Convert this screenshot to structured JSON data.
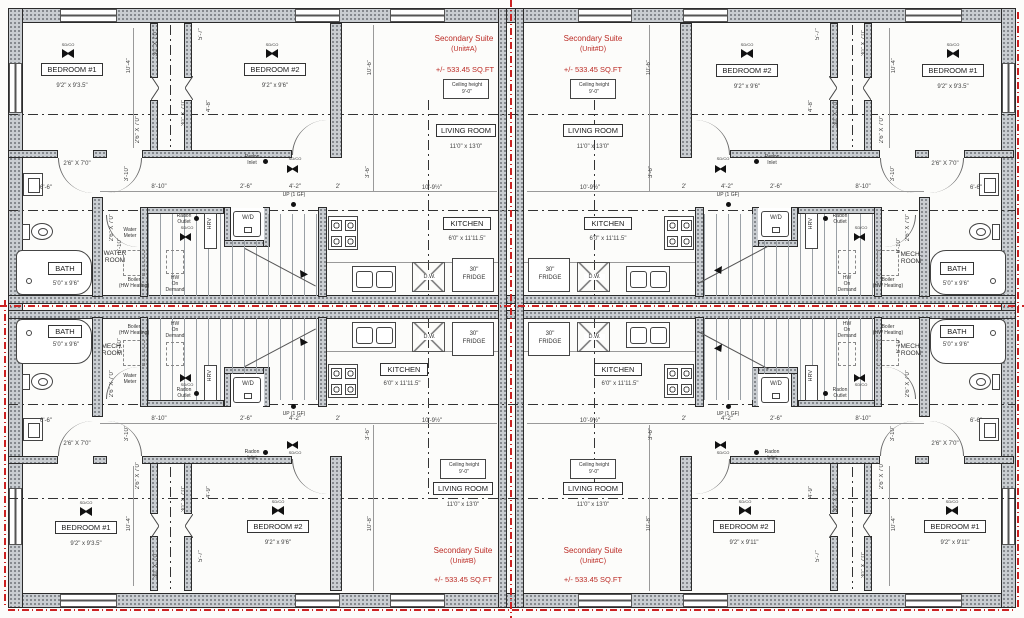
{
  "colors": {
    "accent_red": "#bb2b25",
    "wall_gray": "#c9cdd1"
  },
  "rooms": {
    "bedroom1": "BEDROOM #1",
    "bedroom2": "BEDROOM #2",
    "living": "LIVING ROOM",
    "kitchen": "KITCHEN",
    "bath": "BATH",
    "water_room": "WATER ROOM",
    "mech_room": "MECH. ROOM"
  },
  "sizes": {
    "bedroom1": "9'2\" x 9'3.5\"",
    "bedroom2": "9'2\" x 9'6\"",
    "bedroom_c": "9'2\" x 9'11\"",
    "living": "11'0\" x 13'0\"",
    "kitchen": "6'0\" x 11'11.5\"",
    "bath": "5'0\" x 9'6\""
  },
  "suites": {
    "a": {
      "title": "Secondary Suite",
      "unit": "(Unit#A)",
      "area": "+/- 533.45 SQ.FT"
    },
    "b": {
      "title": "Secondary Suite",
      "unit": "(Unit#B)",
      "area": "+/- 533.45 SQ.FT"
    },
    "c": {
      "title": "Secondary Suite",
      "unit": "(Unit#C)",
      "area": "+/- 533.45 SQ.FT"
    },
    "d": {
      "title": "Secondary Suite",
      "unit": "(Unit#D)",
      "area": "+/- 533.45 SQ.FT"
    }
  },
  "ceiling": {
    "l1": "Ceiling height",
    "l2": "9'-0\""
  },
  "fixtures": {
    "wd": "W/D",
    "hrv": "HRV",
    "fridge1": "30\"",
    "fridge2": "FRIDGE",
    "dw": "D.W.",
    "up": "UP (1 GF)",
    "sdco": "SD/CO"
  },
  "notes": {
    "radon": "Radon",
    "inlet": "Inlet",
    "outlet": "Outlet",
    "water": "Water",
    "meter": "Meter",
    "boiler": "Boiler",
    "boiler2": "(HW Heating)",
    "hw1": "HW",
    "hw2": "On",
    "hw3": "Demand"
  },
  "dims": {
    "d104": "10'-4\"",
    "d57": "5'-7\"",
    "d48": "4'-8\"",
    "d49": "4'-9\"",
    "d106": "10'-6\"",
    "d108": "10'-8\"",
    "d810": "8'-10\"",
    "d26": "2'-6\"",
    "d42": "4'-2\"",
    "d2": "2'",
    "d1092": "10'-9½\"",
    "d610": "6'-10\"",
    "d310": "3'-10\"",
    "d66": "6'-6\"",
    "d36": "3'-6\"",
    "door": "2'6\" X 7'0\"",
    "closet": "30\" X 7'0\""
  }
}
